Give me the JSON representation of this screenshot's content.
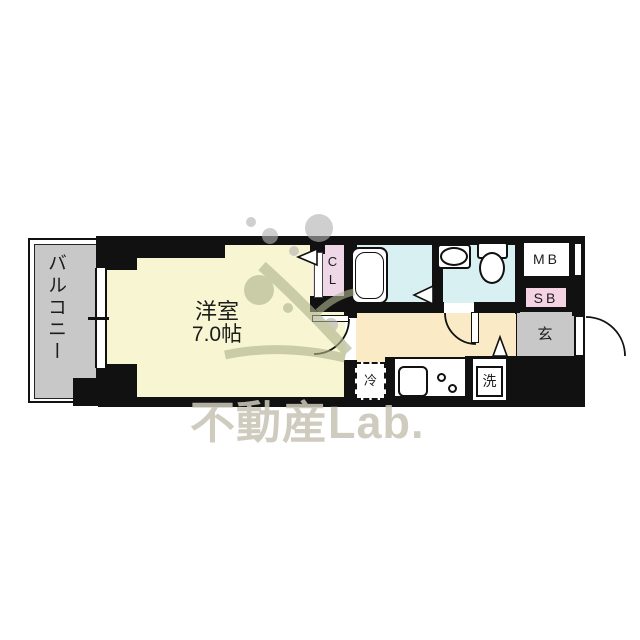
{
  "watermark": {
    "text": "不動産Lab."
  },
  "rooms": {
    "balcony": {
      "label": "バルコニー"
    },
    "main_room": {
      "label": "洋室",
      "size": "7.0帖"
    },
    "closet": {
      "label": "CL"
    },
    "bathroom": {
      "label": ""
    },
    "meter_box": {
      "label": "MB"
    },
    "shoe_box": {
      "label": "SB"
    },
    "entrance": {
      "label": "玄"
    },
    "refrigerator_space": {
      "label": "冷"
    },
    "washing_machine": {
      "label": "洗"
    }
  },
  "icons": {
    "fixtures": [
      "bathtub-icon",
      "toilet-icon",
      "washbasin-icon",
      "kitchen-sink-icon",
      "stove-burner-icon",
      "door-swing-arc",
      "door-direction-triangle",
      "sliding-window",
      "tree-logo-watermark"
    ]
  },
  "colors": {
    "wall": "#111111",
    "room_yellow": "#f8f6d2",
    "corridor_cream": "#faeac6",
    "wet_area_cyan": "#d8f0f1",
    "closet_pink": "#eed7e7",
    "shoebox_pink": "#f6d3e2",
    "gray_area": "#c8c8c8",
    "watermark_text": "#cbc8bb",
    "watermark_olive": "#aeb38e",
    "watermark_gray": "#b3b3b3"
  }
}
